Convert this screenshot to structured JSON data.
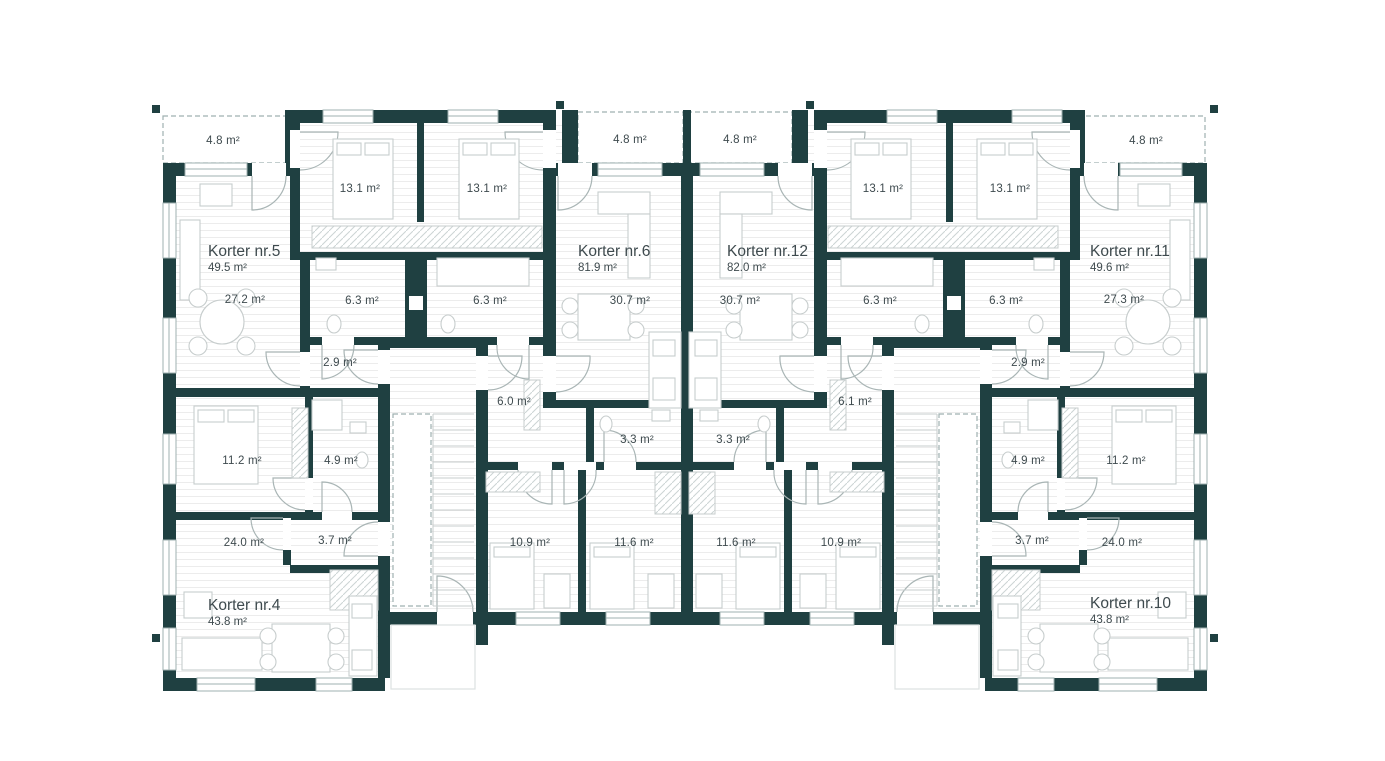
{
  "meta": {
    "kind": "architectural floor plan",
    "units": "m²"
  },
  "palette": {
    "wall": "#1f4041",
    "frame": "#9fb0b0",
    "door": "#a9b5b5",
    "furn": "#c7cdcd",
    "floor_line": "#ececec",
    "label": "#3e4a4e",
    "porch": "#dce1e1"
  },
  "apartments": [
    {
      "id": "k5",
      "name": "Korter nr.5",
      "area": "49.5 m²"
    },
    {
      "id": "k6",
      "name": "Korter nr.6",
      "area": "81.9 m²"
    },
    {
      "id": "k12",
      "name": "Korter nr.12",
      "area": "82.0 m²"
    },
    {
      "id": "k11",
      "name": "Korter nr.11",
      "area": "49.6 m²"
    },
    {
      "id": "k4",
      "name": "Korter nr.4",
      "area": "43.8 m²"
    },
    {
      "id": "k10",
      "name": "Korter nr.10",
      "area": "43.8 m²"
    }
  ],
  "room_labels": [
    {
      "room": "balcony-k5",
      "value": "4.8 m²"
    },
    {
      "room": "balcony-k6",
      "value": "4.8 m²"
    },
    {
      "room": "balcony-k12",
      "value": "4.8 m²"
    },
    {
      "room": "balcony-k11",
      "value": "4.8 m²"
    },
    {
      "room": "bedroom-k5",
      "value": "13.1 m²"
    },
    {
      "room": "bedroom-k6",
      "value": "13.1 m²"
    },
    {
      "room": "bedroom-k12",
      "value": "13.1 m²"
    },
    {
      "room": "bedroom-k11",
      "value": "13.1 m²"
    },
    {
      "room": "living-k5",
      "value": "27.2 m²"
    },
    {
      "room": "bath-k5",
      "value": "6.3 m²"
    },
    {
      "room": "bath-k6",
      "value": "6.3 m²"
    },
    {
      "room": "bath-k12",
      "value": "6.3 m²"
    },
    {
      "room": "bath-k11",
      "value": "6.3 m²"
    },
    {
      "room": "living-k11",
      "value": "27.3 m²"
    },
    {
      "room": "living-k6",
      "value": "30.7 m²"
    },
    {
      "room": "living-k12",
      "value": "30.7 m²"
    },
    {
      "room": "hall-k5",
      "value": "2.9 m²"
    },
    {
      "room": "hall-k11",
      "value": "2.9 m²"
    },
    {
      "room": "corridor-k6",
      "value": "6.0 m²"
    },
    {
      "room": "corridor-k12",
      "value": "6.1 m²"
    },
    {
      "room": "wc-k6",
      "value": "3.3 m²"
    },
    {
      "room": "wc-k12",
      "value": "3.3 m²"
    },
    {
      "room": "bedroom-k4",
      "value": "11.2 m²"
    },
    {
      "room": "bath-k4",
      "value": "4.9 m²"
    },
    {
      "room": "bath-k10",
      "value": "4.9 m²"
    },
    {
      "room": "bedroom-k10",
      "value": "11.2 m²"
    },
    {
      "room": "living-k4",
      "value": "24.0 m²"
    },
    {
      "room": "hall-k4",
      "value": "3.7 m²"
    },
    {
      "room": "bedroom2-k6",
      "value": "10.9 m²"
    },
    {
      "room": "bedroom3-k6",
      "value": "11.6 m²"
    },
    {
      "room": "bedroom3-k12",
      "value": "11.6 m²"
    },
    {
      "room": "bedroom2-k12",
      "value": "10.9 m²"
    },
    {
      "room": "hall-k10",
      "value": "3.7 m²"
    },
    {
      "room": "living-k10",
      "value": "24.0 m²"
    }
  ]
}
